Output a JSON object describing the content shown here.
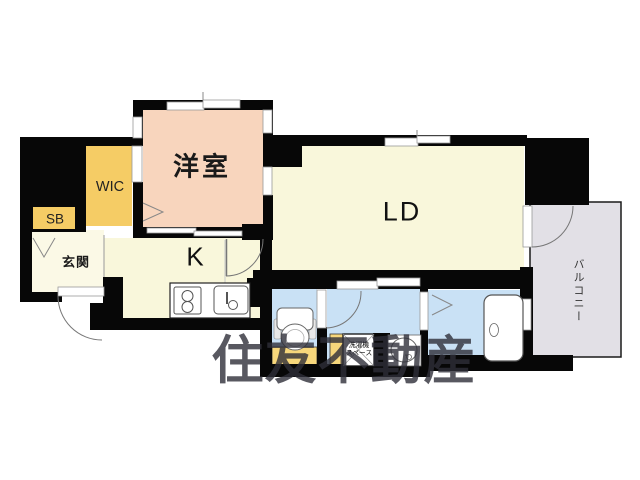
{
  "plan": {
    "rooms": {
      "western_room": "洋室",
      "walk_in_closet": "WIC",
      "shoe_box": "SB",
      "entrance": "玄関",
      "kitchen": "K",
      "living_dining": "LD",
      "balcony": "バルコニー"
    },
    "laundry_space": {
      "line1": "洗濯機",
      "line2": "スペース"
    },
    "watermark": "住友不動産",
    "colors": {
      "wall": "#070707",
      "western_room_fill": "#F8D5BD",
      "closet_fill": "#F5CC65",
      "floor_fill": "#F9F7DB",
      "entrance_fill": "#FBF9E6",
      "wet_area_fill": "#C9E1F5",
      "balcony_fill": "#E2E0E6",
      "mat_fill": "#F7D77B"
    }
  }
}
